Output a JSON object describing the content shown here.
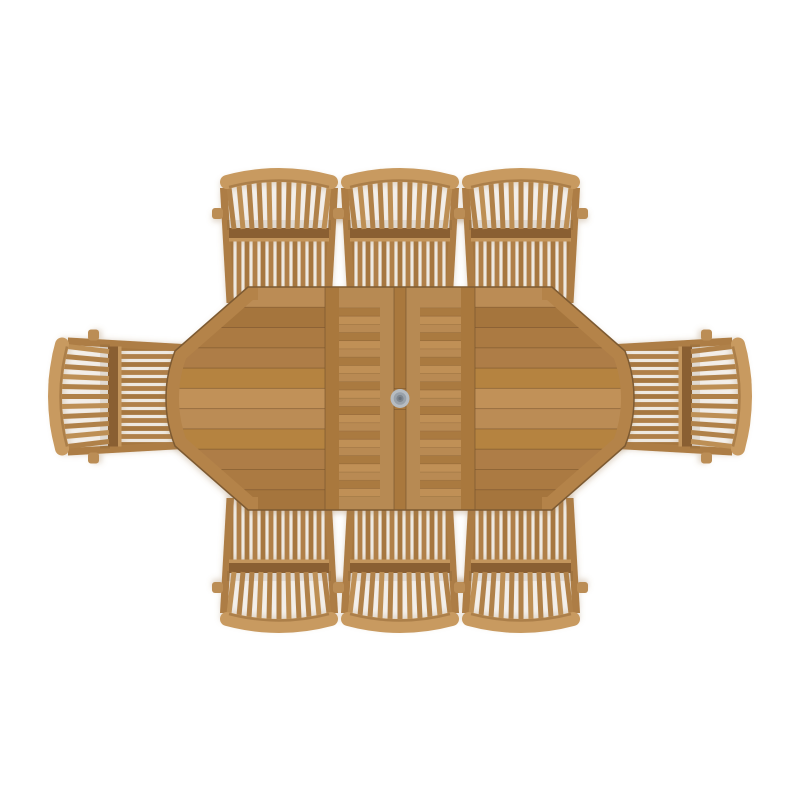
{
  "scene": {
    "subject": "top-down render of an 8 seat teak garden dining set: oval extending table with parasol hole and eight slatted armchairs",
    "background_color": "#ffffff",
    "shadow": {
      "color": "#9c7a4e",
      "opacity": 0.3
    },
    "wood_palette": {
      "base": "#b28048",
      "plank_tones": [
        "#bb8c55",
        "#ab7a42",
        "#b5833f",
        "#a5753d",
        "#c19159",
        "#ae7d46"
      ],
      "seam": "#73512c",
      "rim": "#b48349",
      "edge_line": "#7d5a31",
      "rail": "#a9783e",
      "rail_light": "#b78a52",
      "leaf_slat_tones": [
        "#b98a52",
        "#aa7a41",
        "#c09057"
      ]
    },
    "chair_palette": {
      "crest": "#c89a60",
      "fan_slat": "#b08148",
      "fan_slat_alt": "#bd8f55",
      "rail_dark": "#8a5f31",
      "rail_lit": "#c3955c",
      "seat_slat_a": "#a6773f",
      "seat_slat_b": "#b08049",
      "post": "#ad7d44",
      "arm": "#bb8d55",
      "under_shadow_opacity": 0.1
    },
    "table": {
      "name": "oval-extending-table",
      "left": 166,
      "right": 634,
      "top": 287,
      "bottom": 510,
      "straight_left": 248,
      "straight_right": 552,
      "corner_inner_left": 175,
      "corner_inner_right": 625,
      "corner_y": 351,
      "center_x": 400,
      "center_y": 398.5,
      "rim_band_width": 26,
      "cap_plank_count": 11,
      "cap_plank_pattern": [
        0,
        3,
        1,
        5,
        2,
        4,
        0,
        2,
        5,
        1,
        3
      ],
      "leaf": {
        "left_x": 325,
        "right_x": 475,
        "rail_w": 14,
        "end_rail_h": 13,
        "slat_count": 24,
        "slat_top": 300,
        "slat_bottom": 497,
        "strip_x": 394,
        "strip_w": 12,
        "strip_seam_y": [
          388,
          409
        ]
      },
      "parasol_hole": {
        "cx": 400,
        "cy": 398.5,
        "radii": [
          9.5,
          6.3,
          3.6,
          1.6
        ],
        "colors": [
          "#b6bcc2",
          "#99a1a9",
          "#7e868f",
          "#6a727b"
        ]
      }
    },
    "chairs": {
      "count": 8,
      "glyph": {
        "width": 116,
        "depth": 135,
        "fan_slat_count": 11,
        "seat_slat_count": 13
      },
      "positions": [
        {
          "id": "chair-top-left",
          "x": 279,
          "y": 168,
          "rotation": 0
        },
        {
          "id": "chair-top-center",
          "x": 400,
          "y": 168,
          "rotation": 0
        },
        {
          "id": "chair-top-right",
          "x": 521,
          "y": 168,
          "rotation": 0
        },
        {
          "id": "chair-left",
          "x": 48,
          "y": 396.5,
          "rotation": -90
        },
        {
          "id": "chair-right",
          "x": 752,
          "y": 396.5,
          "rotation": 90
        },
        {
          "id": "chair-bottom-left",
          "x": 279,
          "y": 633,
          "rotation": 180
        },
        {
          "id": "chair-bottom-center",
          "x": 400,
          "y": 633,
          "rotation": 180
        },
        {
          "id": "chair-bottom-right",
          "x": 521,
          "y": 633,
          "rotation": 180
        }
      ]
    }
  }
}
